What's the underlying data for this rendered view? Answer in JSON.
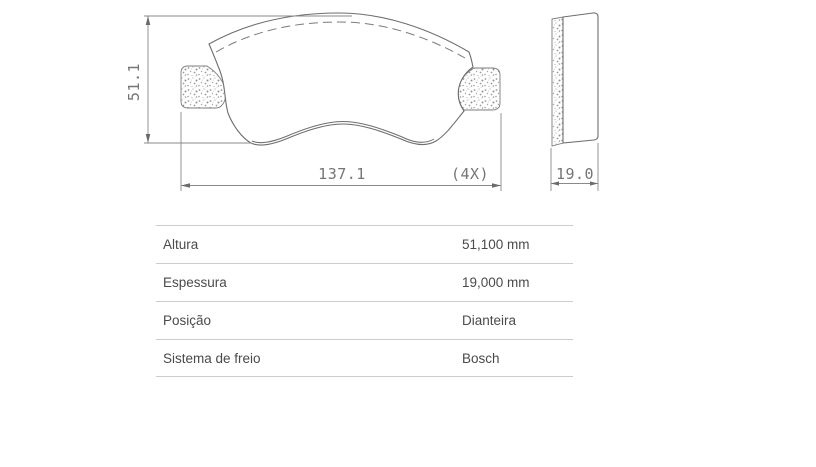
{
  "drawing": {
    "front_view": {
      "height_dim_label": "51.1",
      "width_dim_label": "137.1",
      "qty_label": "(4X)"
    },
    "side_view": {
      "thickness_dim_label": "19.0"
    },
    "colors": {
      "outline": "#6e6e6e",
      "dimension_line": "#8a8a8a",
      "dimension_text": "#757575",
      "stipple_dot": "#9a9a9a"
    }
  },
  "spec_table": {
    "rows": [
      {
        "label": "Altura",
        "value": "51,100 mm"
      },
      {
        "label": "Espessura",
        "value": "19,000 mm"
      },
      {
        "label": "Posição",
        "value": "Dianteira"
      },
      {
        "label": "Sistema de freio",
        "value": "Bosch"
      }
    ],
    "colors": {
      "border": "#cccccc",
      "text": "#4a4a4a"
    }
  }
}
